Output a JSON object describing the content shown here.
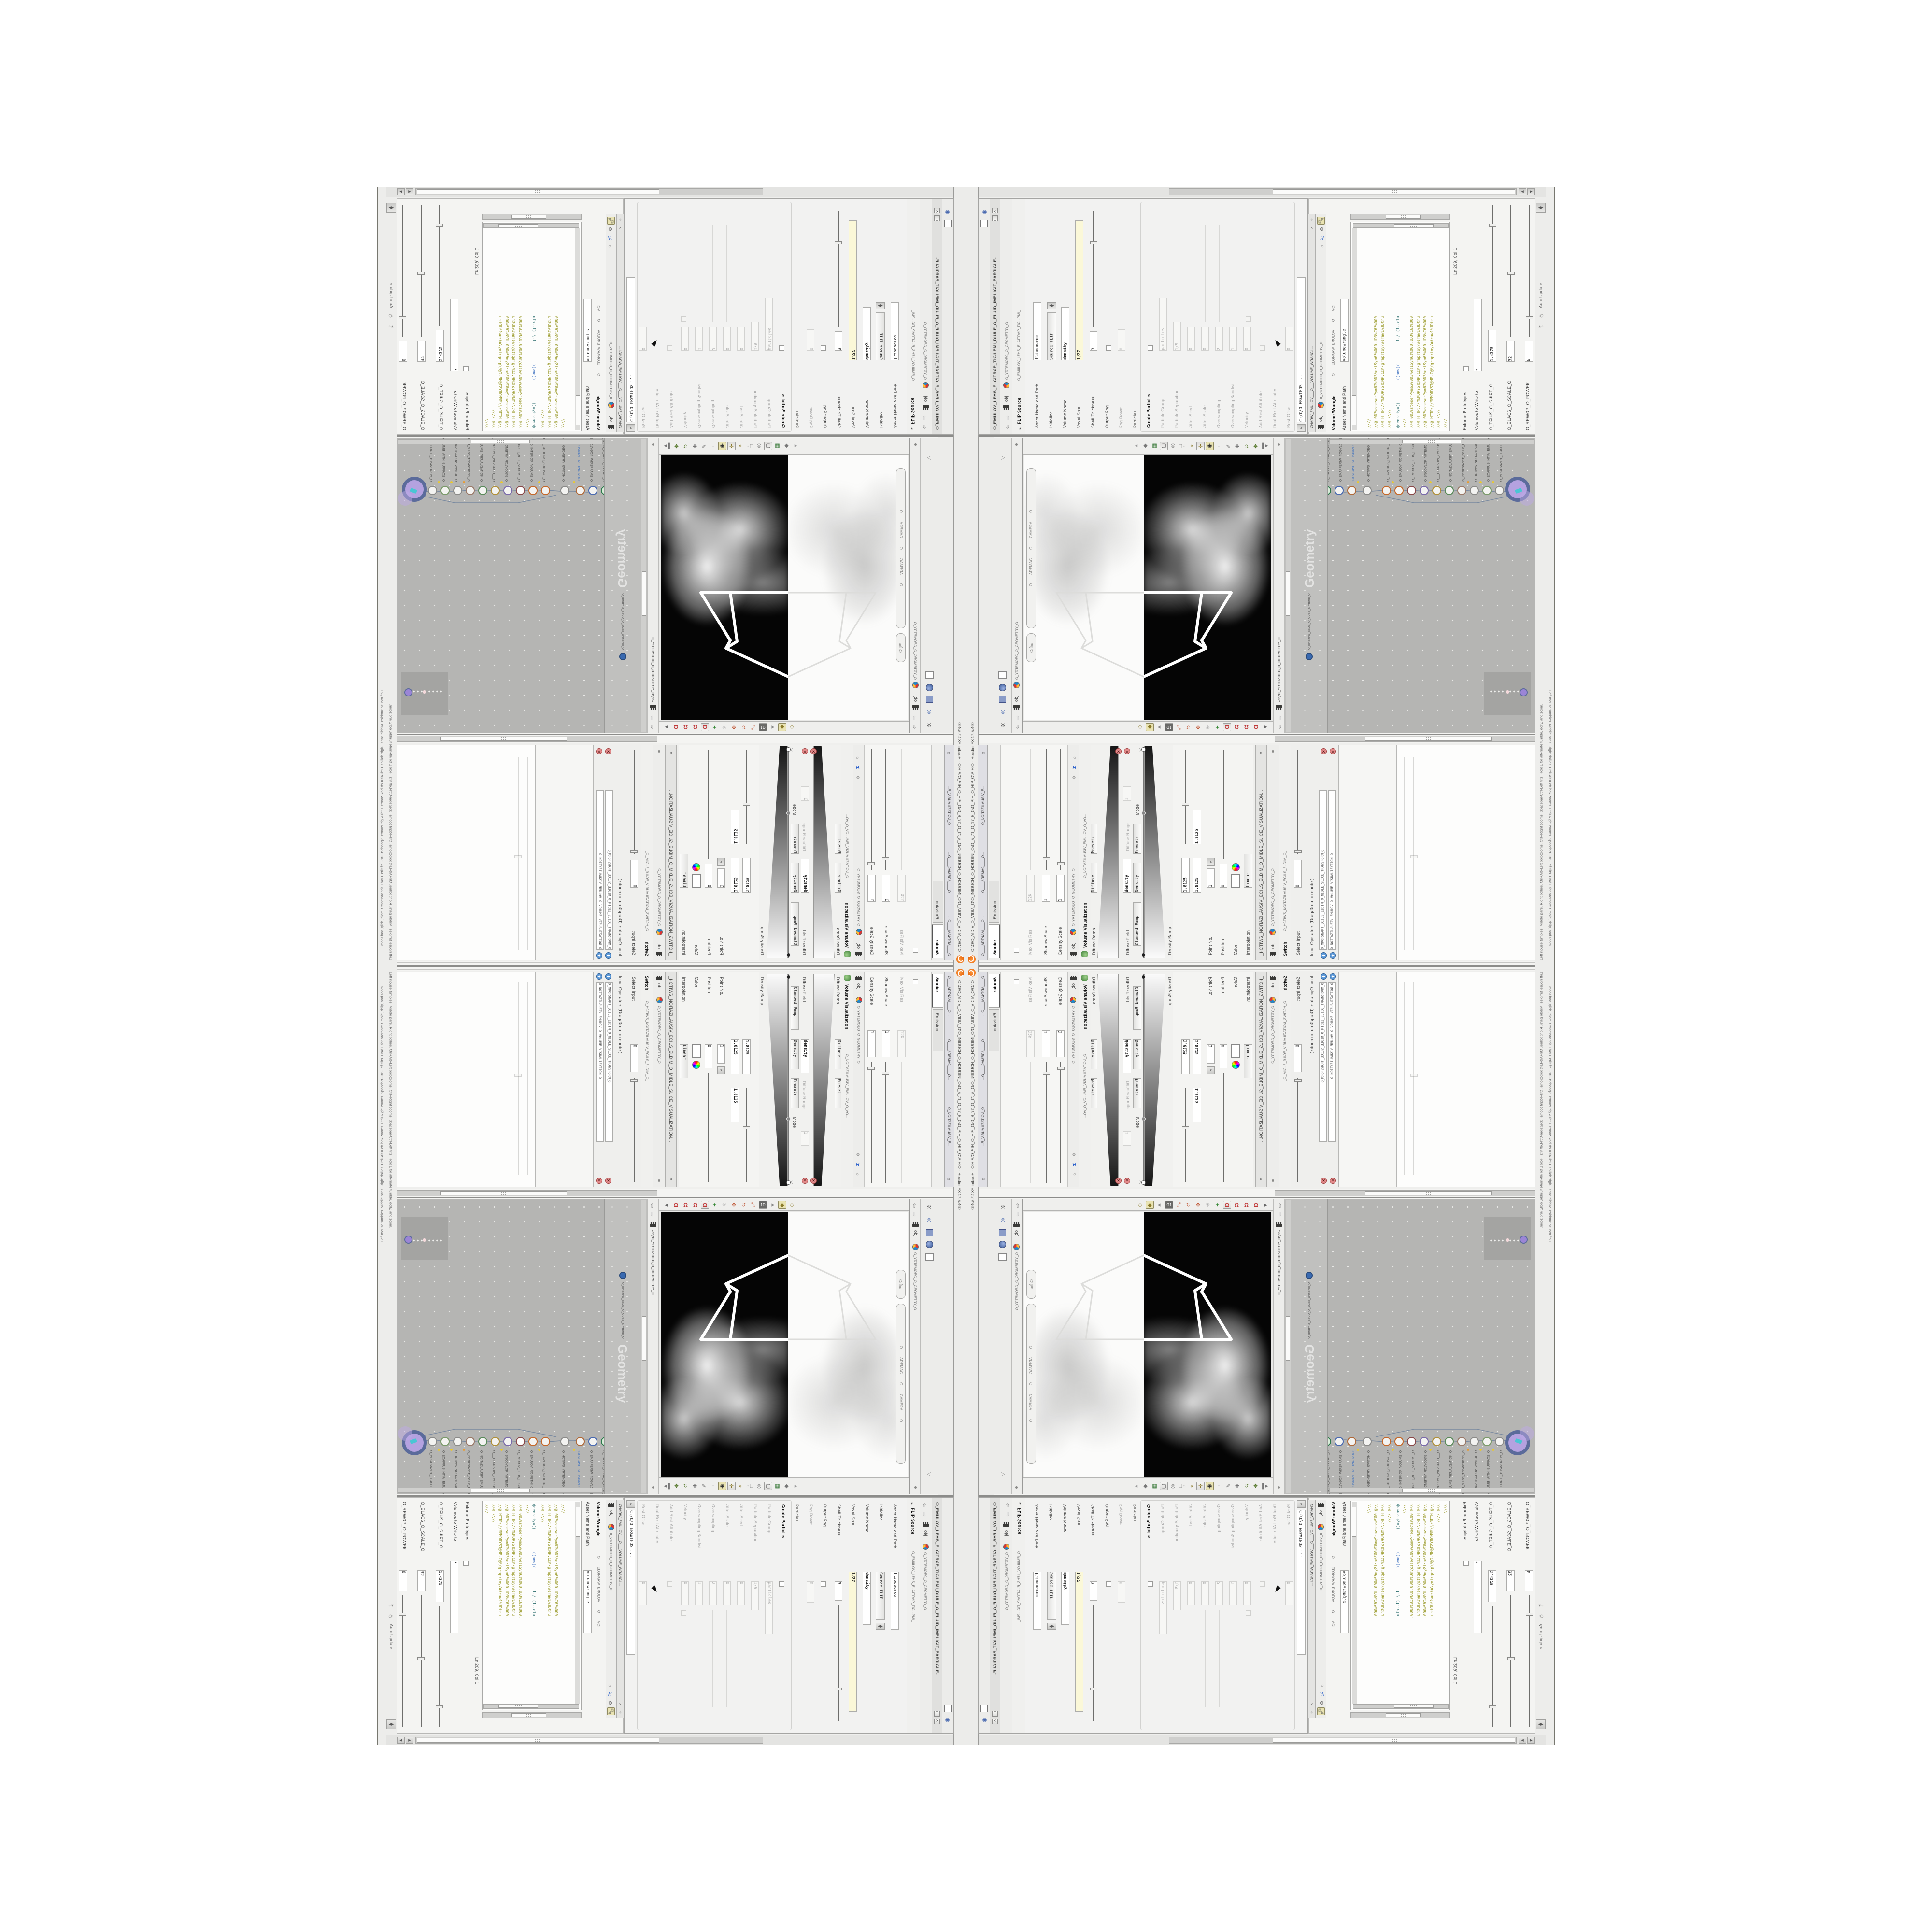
{
  "window": {
    "title": "C:\\O\\O_AIDIV_O_VIDIA_O\\O_INIDUOH_O_HOUDINI_O\\O_5_71_O_17_5_O\\O_PIH_O_HIP_O\\PIH.O - Houdini FX 17.5.460",
    "title_tail": "O.HIP - Houdini FX 17.5.460"
  },
  "status": {
    "hint": "Left mouse tumbles. Middle pans. Right dollies. Ctrl+Alt+Left box-zooms. Ctrl+Right zooms. Spacebar-Ctrl-Left tilts. Hold L for alternate tumble, dolly, and zoom.",
    "auto_update": "Auto Update"
  },
  "crumbs": {
    "obj": "obj",
    "geo": "O_YRTEMOEG_O_GEOMETRY_O",
    "net_path": "/obj/O_YRTEMOEG_O_GEOMETRY_O"
  },
  "pane_tabs": [
    "O____ARTNAM____O...",
    "O____AREMAC____O...",
    "O_NOITAZILAUSIV_E..."
  ],
  "viewport": {
    "projection": "Ortho",
    "camera_pill": "O____AREMAC____O____CAMERA____O",
    "watermark": "Geometry",
    "layout_label": "1D"
  },
  "switch_pane": {
    "tab": "Switch",
    "name": "O_HCTIWS_NOITAZILAUSIV_ECILS_ELDIM_O_",
    "title": "_HCTIWS_NOITAZILAUSIV_ECILS_ELDIM_O_MIDLE_SLICE_VISUALIZATION...",
    "ops_label": "Input Operators (Drag/Drop to reorder)",
    "select_label": "Select Input",
    "select_value": "0",
    "items": [
      "O_NOITAZILAUSIV_EMULOV_O_VOLUME_VISUALIZATION_O",
      "O_MROFSNART_ECILS_ELDIM_O_MIDLE_SLICE_TRANSFORM_O"
    ]
  },
  "point": {
    "interp_label": "Interpolation",
    "interp_value": "Linear",
    "color_label": "Color",
    "position_label": "Position",
    "position_value": "0",
    "point_label": "Point No.",
    "point_value": "1",
    "v0": "1.8125",
    "v1": "1.8125",
    "v2": "1.8125"
  },
  "ramp": {
    "density_label": "Density Ramp",
    "diffuse_label": "Diffuse Ramp",
    "mode_label": "Mode",
    "mode_value": "Clamped Ramp",
    "density": "Density",
    "diffuse": "Diffuse",
    "presets": "Presets",
    "diffuse_field_label": "Diffuse Field",
    "diffuse_field_value": "density",
    "diffuse_range_label": "Diffuse Range",
    "diffuse_range_value": "1",
    "density_field_label": "Density Field",
    "density_field_value": "density"
  },
  "viz": {
    "tab": "Volume Visualization",
    "name": "O_NOITAZILAUSIV_EMULOV_O_VO...",
    "rows": [
      {
        "label": "Density Scale",
        "value": "1"
      },
      {
        "label": "Shadow Scale",
        "value": "1"
      },
      {
        "label": "Max Vis Res",
        "value": "128"
      }
    ],
    "tabs": [
      "Smoke",
      "Emission"
    ]
  },
  "network": {
    "comment": "1.0.SLOPBT.STEP.3DIADB",
    "nodes": [
      {
        "type": "Transform",
        "name": "O_MROFSNART_TLUSER_RESULT_TRANSFORM_O"
      },
      {
        "type": "Merge",
        "name": "O_ECAFRUS_HTIW_EMULOV_VOLUME_WITH_SURFACE_O"
      },
      {
        "type": "Switch",
        "name": "O_HCTIWS_NOITAZILAUSIV_ECILS_ELDIM_O_MIDLE_SLICE_VISUALIZATION_SWITCH_O"
      },
      {
        "type": "Transform",
        "name": "O_MROFSNART_ECILS_ELDIM_O_MIDLE_SLICE_TRANSFORM_O"
      },
      {
        "type": "Volume Visualiz",
        "name": "O_NOITAZILAUSIV_EMULOV_O_VOLUME_VISUALIZATION_O"
      },
      {
        "type": "Volume Wrangle",
        "name": "O___ELGNARW_EMULOV_O_VOLUME_WRANGLE___O"
      },
      {
        "type": "VDB from Polygons",
        "name": "O_SNOGYLOP_YRTEMOEG_MORF_EMULOV_BDV_O_VDB_VOLUME_FROM_GEOMETRY_POLYGONS_O"
      },
      {
        "type": "FLIP Source",
        "name": "O_EMULOV_LEHS_ELCITRAP_TICILPMI_DIULF_O_FLUID_IMPLICIT_PARTICLE_SHEL_VOLUME_O"
      },
      {
        "type": "Clip",
        "name": "O_EMULOV_ROIRETNI_O_INTERIOR_VOLUME_O"
      },
      {
        "type": "Clip",
        "name": "O_ECAFRUS_ROIRETNI_O_INTERIOR_SURFACE_O"
      },
      {
        "type": "Switch",
        "name": "O_HCTIWS_YRTEMOEG_LANRETXE_LANRETNI_O_INTERNAL_EXTERNAL_GEOMETRY_SWITCH_O"
      },
      {
        "type": "Blast",
        "name": "O_TSALB_PETS_TPOLS_BLAST_O"
      },
      {
        "type": "PolyWire",
        "name": "O_EMARFERIW_NOGYLOP_EREHPS_SPHERE_POLYGON_WIREFRAME_O"
      },
      {
        "type": "an_CubeSphere",
        "name": "O_EREHPS_EBUC_O_CUBE_SPHERE_O"
      }
    ]
  },
  "wrangle": {
    "tab": "Volume Wrangle",
    "tab_strip": "O____ELGNARW_EMULOV____O____VOI",
    "window_title": "GNARW_EMULOV___O___VOLUME_WRANGL...",
    "asset_label": "Asset Name and Path",
    "asset_value": "volumewrangle",
    "params": [
      {
        "label": "O_REWOP_O_POWER...",
        "value": "6"
      },
      {
        "label": "O_ELACS_O_SCALE_O",
        "value": "32"
      },
      {
        "label": "O_TFIHS_O_SHIFT_O",
        "value": "1.4375"
      }
    ],
    "volumes_label": "Volumes to Write to",
    "volumes_value": "*",
    "enforce_label": "Enforce Prototypes",
    "cursor_pos": "Ln 209, Col 1",
    "path_field": "C:/O/O_ERAWTFOS_...",
    "vex_a": "@density=((",
    "vex_b": " ((pow((",
    "vex_c": " 1./ (1.-cla",
    "code": [
      "////",
      "//@ \\\\\\\\",
      "//@ HTTP://MEMORYST@MP.C@M/graphtoy/#draw1%3Dtru",
      "//@ 0D3%steserPym62%0D3%eziSym62%000.1D3%C62%000.",
      "//@ HTTP://MEMORYST@MP.C@M/graphtoy/#draw1%3Dtru",
      "//@ 0D3%steserPym62%0D3%eziSym62%000.1D3%C62%000.",
      "////",
      "//@ \\\\\\\\",
      "//@ HTTP://MEMORYST@MP.C@M/graphtoy/#draw1%3Dtru",
      "//@ 0D3%steserPym62%0D3%eziSym62%000.1D3%C62%000.",
      "////"
    ]
  },
  "flip": {
    "tab": "FLIP Source",
    "name": "O_EMULOV_LEHS_ELCITRAP_TICILPMI_",
    "window_title": "O_EMULOV_LEHS_ELCITRAP_TICILPMI_DIULF_O_FLUID_IMPLICIT_PARTICLE...",
    "rows": [
      {
        "label": "Rest Offset",
        "value": "0"
      },
      {
        "label": "Dual Rest Attributes",
        "value": ""
      },
      {
        "label": "Add Rest Attribute",
        "value": ""
      },
      {
        "label": "Velocity",
        "value": "0"
      },
      {
        "label": "Oversampling Bandwi...",
        "value": "1"
      },
      {
        "label": "Oversampling",
        "value": "2"
      },
      {
        "label": "Jitter Scale",
        "value": "0"
      },
      {
        "label": "Jitter Seed",
        "value": "0"
      },
      {
        "label": "Particle Separation",
        "value": "1/9"
      },
      {
        "label": "Particle Group",
        "value": "particles"
      },
      {
        "label": "Create Particles",
        "value": ""
      },
      {
        "label": "Particles",
        "value": ""
      },
      {
        "label": "Fog Boost",
        "value": "0"
      },
      {
        "label": "Output Fog",
        "value": ""
      },
      {
        "label": "Shell Thickness",
        "value": "3"
      },
      {
        "label": "Voxel Size",
        "value": "1/27"
      },
      {
        "label": "Volume Name",
        "value": "density"
      },
      {
        "label": "Initialize",
        "value": "Source FLIP"
      },
      {
        "label": "Asset Name and Path",
        "value": "flipsource"
      }
    ]
  },
  "colors": {
    "accent_orange": "#e86a10",
    "node_purple": "#b4a2e0",
    "node_ring": "#4a5a8a",
    "wire": "#7a8aa0",
    "code_olive": "#9a9a2a",
    "code_blue": "#3b6fbf",
    "field_yellow": "#fbf8d8",
    "delete_red": "#e28a8a",
    "insert_blue": "#5b97d6",
    "network_bg": "#b5b5b3"
  }
}
